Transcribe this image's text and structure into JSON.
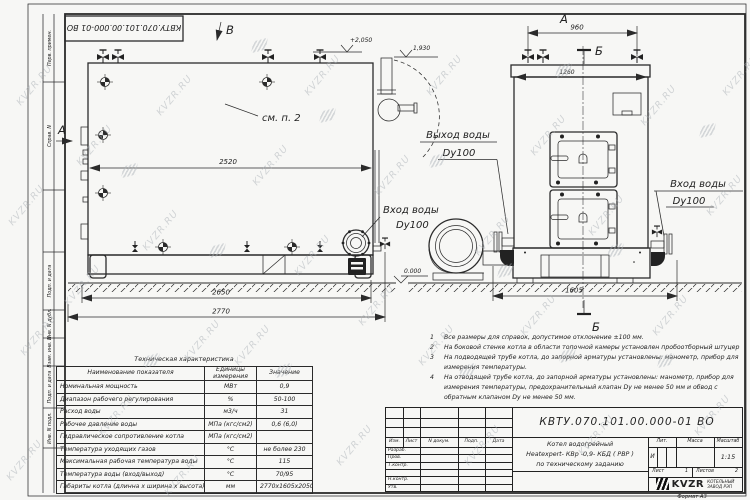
{
  "doc": {
    "number": "КВТУ.070.101.00.000-01 ВО",
    "format": "Формат  А3"
  },
  "watermark": {
    "text": "KVZR.RU",
    "color": "#aab0b6"
  },
  "frame_strip": {
    "items": [
      "Перв. примен.",
      "Справ. N",
      "Подп. и дата",
      "Инв. N дубл.",
      "Взам. инв. N",
      "Подп. и дата",
      "Инв. N подл."
    ]
  },
  "drawing": {
    "side_view": {
      "view_arrow_a": "А",
      "view_arrow_b": "В",
      "see_note": "см. п. 2",
      "dim_2520": "2520",
      "dim_2650": "2650",
      "dim_2770": "2770",
      "elev_top": "+2,050",
      "elev_chimney": "1,930",
      "elev_zero": "0.000",
      "inlet_label": "Вход воды",
      "inlet_dn": "Dy100"
    },
    "front_view": {
      "view_label_a": "А",
      "section_b_top": "Б",
      "section_b_bottom": "Б",
      "dim_960": "960",
      "dim_1260": "1260",
      "dim_1605": "1605",
      "outlet_label": "Выход воды",
      "outlet_dn": "Dy100",
      "inlet_label": "Вход воды",
      "inlet_dn": "Dy100"
    }
  },
  "notes": {
    "items": [
      {
        "n": "1",
        "text": "Все размеры для справок, допустимое отклонение ±100 мм."
      },
      {
        "n": "2",
        "text": "На боковой стенке котла в области топочной камеры установлен пробоотборный штуцер"
      },
      {
        "n": "3",
        "text": "На подводящей трубе котла, до запорной арматуры установлены: манометр, прибор для измерения температуры."
      },
      {
        "n": "4",
        "text": "На отводящей трубе котла, до запорной арматуры установлены: манометр, прибор для измерения температуры, предохранительный клапан Dy не менее 50 мм и обвод с обратным клапаном Dy не менее 50 мм."
      }
    ]
  },
  "tech_table": {
    "title": "Техническая характеристика",
    "headers": [
      "Наименование показателя",
      "Единицы измерения",
      "Значение"
    ],
    "rows": [
      [
        "Номинальная мощность",
        "МВт",
        "0,9"
      ],
      [
        "Диапазон рабочего регулирования",
        "%",
        "50-100"
      ],
      [
        "Расход воды",
        "м3/ч",
        "31"
      ],
      [
        "Рабочее давление воды",
        "МПа (кгс/см2)",
        "0,6 (6,0)"
      ],
      [
        "Гидравлическое сопротивление котла",
        "МПа (кгс/см2)",
        "0,06 (0,6)"
      ],
      [
        "Температура уходящих газов",
        "°С",
        "не более 230"
      ],
      [
        "Максимальная рабочая температура воды",
        "°С",
        "115"
      ],
      [
        "Температура воды (вход/выход)",
        "°С",
        "70/95"
      ],
      [
        "Габариты котла (длинна х ширина х высота)",
        "мм",
        "2770х1605х2050"
      ]
    ]
  },
  "title_block": {
    "cols": [
      "Изм.",
      "Лист",
      "N докум.",
      "Подп.",
      "Дата"
    ],
    "sign_rows": [
      "Разраб.",
      "Пров.",
      "Т.контр.",
      "",
      "Н.контр.",
      "Утв."
    ],
    "product_lines": [
      "Котел водогрейный",
      "Heatexpert- КВр -0,9- КБД ( РВР )",
      "по техническому заданию"
    ],
    "lit_label": "Лит.",
    "mass_label": "Масса",
    "scale_label": "Масштаб",
    "lit_value": "И",
    "scale_value": "1:15",
    "sheet_label": "Лист",
    "sheet_value": "1",
    "sheets_label": "Листов",
    "sheets_value": "2",
    "logo_text": "KVZR",
    "company_lines": [
      "КОТЕЛЬНЫЙ",
      "ЗАВОД РЭП"
    ]
  }
}
